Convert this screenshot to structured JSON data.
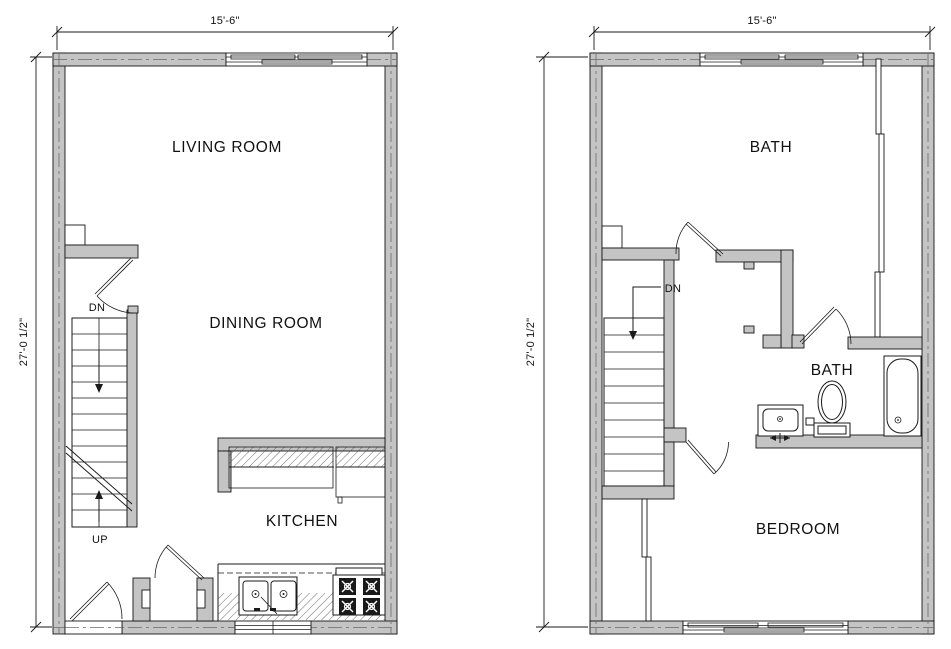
{
  "document": {
    "type": "architectural floor plan, two levels",
    "background": "#ffffff"
  },
  "colors": {
    "wall_fill": "#c4c4c4",
    "line": "#1a1a1a"
  },
  "first_floor": {
    "dim_width": "15'-6\"",
    "dim_height": "27'-0 1/2\"",
    "living_room": "LIVING ROOM",
    "dining_room": "DINING ROOM",
    "kitchen": "KITCHEN",
    "stair_down": "DN",
    "stair_up": "UP"
  },
  "second_floor": {
    "dim_width": "15'-6\"",
    "dim_height": "27'-0 1/2\"",
    "bath_large": "BATH",
    "bath_small": "BATH",
    "bedroom": "BEDROOM",
    "stair_down": "DN"
  }
}
